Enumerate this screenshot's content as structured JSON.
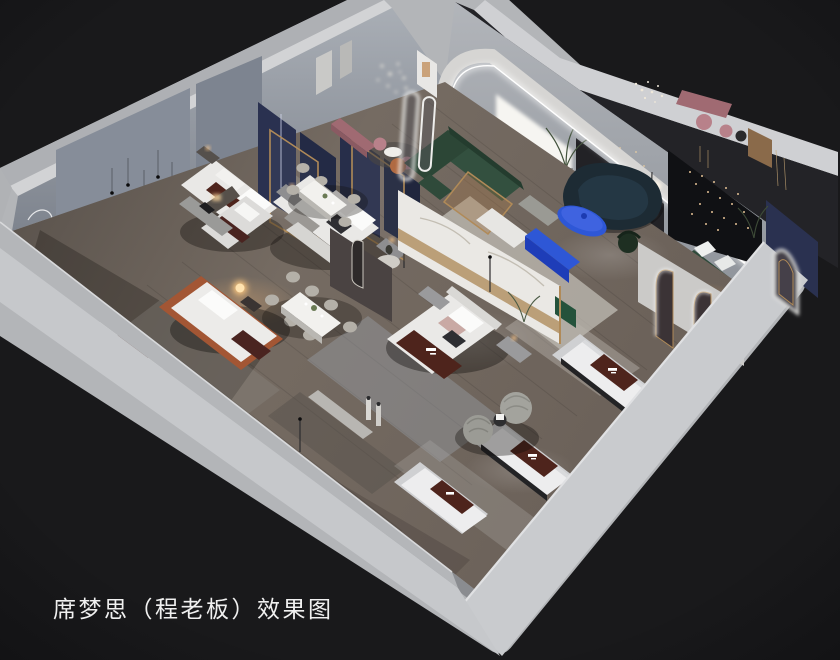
{
  "caption": {
    "text": "席梦思（程老板）效果图"
  },
  "palette": {
    "bg": "#19191b",
    "slabMid": "#b3b5b8",
    "slabLight": "#c9cbce",
    "slabTop": "#d2d3d5",
    "slabOuter": "#aeb0b4",
    "apron": "#c6c8cb",
    "wallInnerLight": "#a6abb2",
    "wallInnerDark": "#7e858f",
    "wallPanel": "#868d99",
    "floorLight": "#7b7168",
    "floorMid": "#695f58",
    "floorDark": "#4e4641",
    "rugBlue": "#9aa0a7",
    "rugCream": "#cfccc4",
    "marble": "#eae8e4",
    "gold": "#b08a58",
    "navyPanel": "#2a3150",
    "greenSofa": "#33503f",
    "benchGreen": "#2e4a3a",
    "tealSofa": "#1d2b34",
    "accentBlue": "#2e57d6",
    "accentBlueDark": "#1e3db8",
    "mauve": "#a06a72",
    "rose": "#b8818a",
    "runnerBrown": "#4e241c",
    "mattressWhite": "#ededee",
    "rustBed": "#a35634",
    "warmLight": "#ffc98a",
    "led": "#ffffff",
    "blackWall": "#101114",
    "caption": "#f0f0f0"
  }
}
